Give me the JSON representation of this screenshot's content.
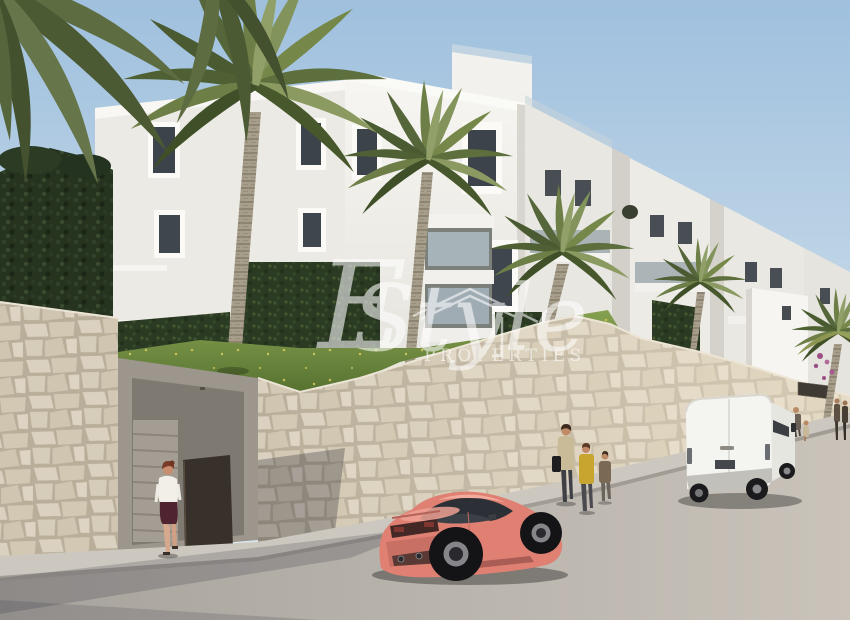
{
  "meta": {
    "type": "architectural-render-photo",
    "description": "New-build white apartment complex with palm trees, stone retaining wall, street with parked coral coupe and white van, pedestrians, agency watermark"
  },
  "watermark": {
    "brand_initial": "E",
    "brand_name": "Style",
    "brand_subtitle": "PROPERTIES"
  },
  "scene": {
    "objects": [
      "blue sky",
      "white apartment building with balconies",
      "palm trees",
      "trimmed dark hedge",
      "ivy covered ground wall",
      "grass slope with small yellow flowers",
      "natural stone retaining wall",
      "concrete entrance with stairs and open brown door",
      "woman walking up entrance stairs",
      "sidewalk and asphalt street",
      "coral sports coupe parked",
      "white panel van parked",
      "pedestrians walking along wall",
      "dark entrance sign plaque"
    ]
  },
  "palette": {
    "sky_top": "#9fc0de",
    "sky_bottom": "#e3ecf1",
    "building_white": "#f5f4f0",
    "building_shadow": "#d8d6cf",
    "window_glass": "#3d434a",
    "stone_wall": "#d6ccba",
    "stone_joint": "#b9ae9a",
    "hedge_green": "#26331f",
    "grass_green": "#6c8a3f",
    "road_gray": "#b5b1aa",
    "sidewalk_gray": "#cdc8bf",
    "car_body": "#df8073",
    "van_body": "#f4f4f0",
    "door_brown": "#38302a",
    "sign_plaque": "#3f3a33",
    "watermark_white": "#ffffff"
  }
}
